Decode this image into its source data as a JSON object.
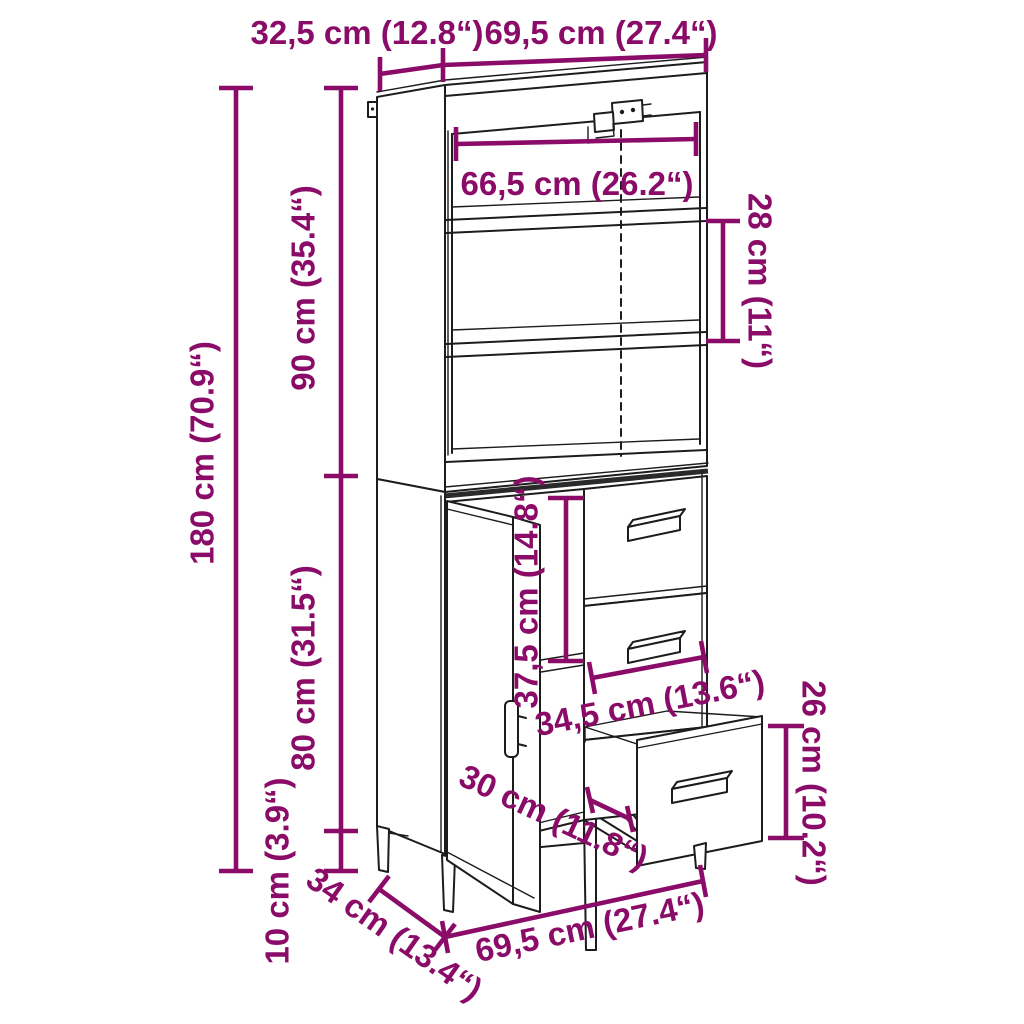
{
  "accent_color": "#8a0c68",
  "line_color": "#1c1c1c",
  "dimensions": {
    "top_depth": "32,5 cm (12.8“)",
    "top_width": "69,5 cm (27.4“)",
    "inner_width": "66,5 cm (26.2“)",
    "shelf_gap": "28 cm (11“)",
    "upper_height": "90 cm (35.4“)",
    "total_height": "180 cm (70.9“)",
    "lower_height": "80 cm (31.5“)",
    "leg_height": "10 cm (3.9“)",
    "inner_drawer_height": "37,5 cm (14.8“)",
    "drawer_width": "34,5 cm (13.6“)",
    "open_drawer_height": "26 cm (10.2“)",
    "drawer_depth": "30 cm (11.8“)",
    "base_depth": "34 cm (13.4“)",
    "base_width": "69,5 cm (27.4“)"
  }
}
